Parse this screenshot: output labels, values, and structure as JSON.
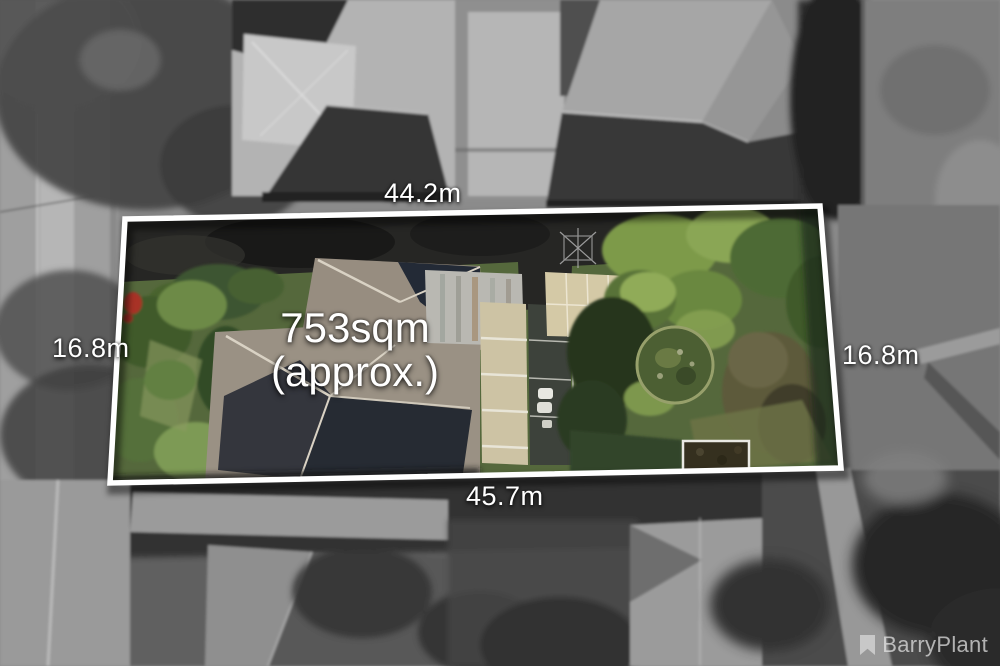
{
  "annotations": {
    "top_dimension": "44.2m",
    "left_dimension": "16.8m",
    "right_dimension": "16.8m",
    "bottom_dimension": "45.7m",
    "area_value": "753sqm",
    "area_qualifier": "(approx.)"
  },
  "watermark": {
    "brand": "BarryPlant",
    "icon": "bookmark-icon"
  },
  "colors": {
    "boundary_outline": "#ffffff",
    "annotation_text": "#ffffff",
    "watermark_text": "#e6e6e6"
  }
}
